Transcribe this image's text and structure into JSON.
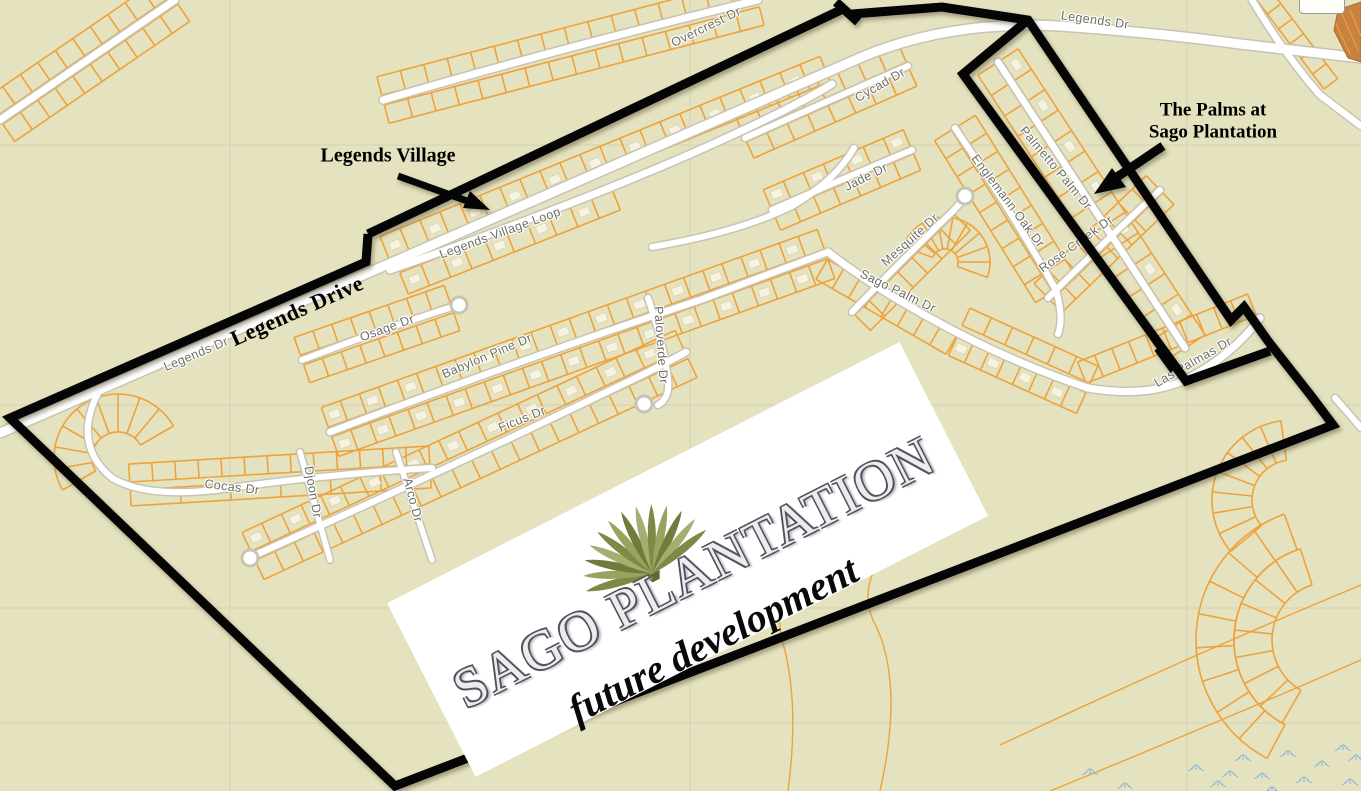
{
  "title": "Sago Plantation future development map",
  "annotations": {
    "legends_village": {
      "text": "Legends Village"
    },
    "the_palms": {
      "line1": "The Palms at",
      "line2": "Sago Plantation"
    },
    "legends_drive": {
      "text": "Legends Drive"
    }
  },
  "logo": {
    "name": "SAGO PLANTATION",
    "tagline": "future development",
    "palm_icon": "palm-frond-icon"
  },
  "map": {
    "street_labels": [
      {
        "text": "Legends Dr",
        "x": 196,
        "y": 354,
        "rot": -23
      },
      {
        "text": "Legends Dr",
        "x": 1095,
        "y": 20,
        "rot": 8
      },
      {
        "text": "Legends Village Loop",
        "x": 500,
        "y": 233,
        "rot": -20
      },
      {
        "text": "Overcrest Dr",
        "x": 706,
        "y": 27,
        "rot": -26
      },
      {
        "text": "Cycad Dr",
        "x": 880,
        "y": 85,
        "rot": -30
      },
      {
        "text": "Jade Dr",
        "x": 866,
        "y": 177,
        "rot": -27
      },
      {
        "text": "Mesquite Dr",
        "x": 910,
        "y": 240,
        "rot": -42
      },
      {
        "text": "Englemann Oak Dr",
        "x": 1008,
        "y": 201,
        "rot": 53
      },
      {
        "text": "Sago Palm Dr",
        "x": 898,
        "y": 291,
        "rot": 26
      },
      {
        "text": "Rose Creek Dr",
        "x": 1076,
        "y": 244,
        "rot": -36
      },
      {
        "text": "Palmetto Palm Dr",
        "x": 1056,
        "y": 168,
        "rot": 50
      },
      {
        "text": "Las Palmas Dr",
        "x": 1193,
        "y": 362,
        "rot": -30
      },
      {
        "text": "Osage Dr",
        "x": 387,
        "y": 328,
        "rot": -20
      },
      {
        "text": "Babylon Pine Dr",
        "x": 487,
        "y": 356,
        "rot": -23
      },
      {
        "text": "Ficus Dr",
        "x": 522,
        "y": 419,
        "rot": -22
      },
      {
        "text": "Paloverde Dr",
        "x": 661,
        "y": 345,
        "rot": 86
      },
      {
        "text": "Cocas Dr",
        "x": 232,
        "y": 487,
        "rot": 7
      },
      {
        "text": "Djoon Dr",
        "x": 313,
        "y": 492,
        "rot": 80
      },
      {
        "text": "Arco Dr",
        "x": 413,
        "y": 500,
        "rot": 75
      }
    ],
    "colors": {
      "background": "#e5e2bf",
      "lot_lines": "#eda33c",
      "road_fill": "#ffffff",
      "road_casing": "#c6c4b4",
      "boundary_black": "#050505",
      "street_label_gray": "#6e6e66",
      "house_fill": "#f6f3e0",
      "marsh_blue": "#85b7dc",
      "patch_brown": "#c8813f",
      "grid_gray": "#d6d3b3",
      "palm_greens": [
        "#7d8a45",
        "#98a35d",
        "#6f7c3b",
        "#a5ad70"
      ]
    }
  }
}
